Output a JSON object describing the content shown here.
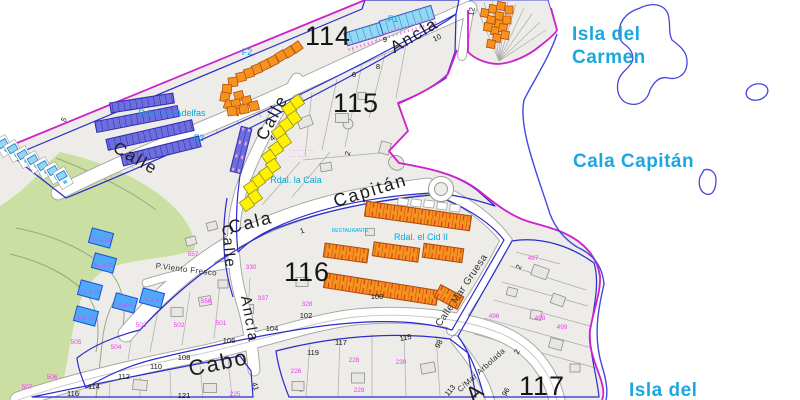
{
  "map": {
    "sea": {
      "isla_carmen_1": "Isla del",
      "isla_carmen_2": "Carmen",
      "cala_capitan": "Cala Capitán",
      "isla_del_partial": "Isla del"
    },
    "zones": [
      {
        "label": "114",
        "x": 328,
        "y": 45
      },
      {
        "label": "115",
        "x": 356,
        "y": 112
      },
      {
        "label": "116",
        "x": 307,
        "y": 281
      },
      {
        "label": "117",
        "x": 542,
        "y": 395
      }
    ],
    "streets": [
      {
        "name": "calle-top-left",
        "label": "Calle",
        "x": 133,
        "y": 163,
        "rot": 30,
        "size": 17
      },
      {
        "name": "ancla-top",
        "label": "Ancla",
        "x": 417,
        "y": 40,
        "rot": -31,
        "size": 17
      },
      {
        "name": "calle-steep",
        "label": "Calle",
        "x": 277,
        "y": 120,
        "rot": -62,
        "size": 17
      },
      {
        "name": "calle-mid",
        "label": "Calle",
        "x": 224,
        "y": 247,
        "rot": 85,
        "size": 15
      },
      {
        "name": "ancla-mid",
        "label": "Ancla",
        "x": 245,
        "y": 320,
        "rot": 80,
        "size": 15
      },
      {
        "name": "cala",
        "label": "Cala",
        "x": 252,
        "y": 228,
        "rot": -14,
        "size": 18
      },
      {
        "name": "capitan",
        "label": "Capitán",
        "x": 372,
        "y": 196,
        "rot": -17,
        "size": 18
      },
      {
        "name": "cabo",
        "label": "Cabo",
        "x": 220,
        "y": 370,
        "rot": -12,
        "size": 22
      },
      {
        "name": "mar-gruesa",
        "label": "Calle Mar Gruesa",
        "x": 464,
        "y": 292,
        "rot": -56,
        "size": 10
      },
      {
        "name": "mar-arbolada",
        "label": "C/Mar Arbolada",
        "x": 483,
        "y": 372,
        "rot": -42,
        "size": 8
      },
      {
        "name": "viento-fresco",
        "label": "P.Viento Fresco",
        "x": 186,
        "y": 272,
        "rot": 7,
        "size": 8
      },
      {
        "name": "avenue-partial",
        "label": "A",
        "x": 480,
        "y": 398,
        "rot": -40,
        "size": 22
      }
    ],
    "urbanizations": [
      {
        "name": "f1",
        "label": "F1",
        "x": 393,
        "y": 22,
        "size": 9
      },
      {
        "name": "f2",
        "label": "F2",
        "x": 247,
        "y": 55,
        "size": 9
      },
      {
        "name": "f3",
        "label": "F3",
        "x": 199,
        "y": 141,
        "size": 9
      },
      {
        "name": "adelfas",
        "label": "Rdal. las Adelfas",
        "x": 172,
        "y": 116,
        "size": 9
      },
      {
        "name": "la-cala",
        "label": "Rdal. la Cala",
        "x": 296,
        "y": 183,
        "size": 9
      },
      {
        "name": "cid",
        "label": "Rdal. el Cid II",
        "x": 421,
        "y": 240,
        "size": 9
      },
      {
        "name": "restaurante",
        "label": "RESTAURANTE",
        "x": 350,
        "y": 232,
        "size": 5
      }
    ],
    "villas": [
      {
        "label": "21 al 24",
        "x": 101,
        "y": 242
      },
      {
        "label": "17 al 20",
        "x": 104,
        "y": 267
      },
      {
        "label": "13 al 16",
        "x": 90,
        "y": 294
      },
      {
        "label": "9 al 12",
        "x": 86,
        "y": 320
      },
      {
        "label": "5 al 8",
        "x": 125,
        "y": 307
      },
      {
        "label": "1 al 4",
        "x": 152,
        "y": 302
      }
    ],
    "parcel_numbers": [
      {
        "v": "557",
        "x": 193,
        "y": 256
      },
      {
        "v": "556",
        "x": 206,
        "y": 303
      },
      {
        "v": "330",
        "x": 251,
        "y": 269
      },
      {
        "v": "337",
        "x": 263,
        "y": 300
      },
      {
        "v": "505",
        "x": 76,
        "y": 344
      },
      {
        "v": "504",
        "x": 116,
        "y": 349
      },
      {
        "v": "503",
        "x": 141,
        "y": 327
      },
      {
        "v": "502",
        "x": 179,
        "y": 327
      },
      {
        "v": "501",
        "x": 221,
        "y": 325
      },
      {
        "v": "506",
        "x": 52,
        "y": 379
      },
      {
        "v": "507",
        "x": 27,
        "y": 389
      },
      {
        "v": "225",
        "x": 235,
        "y": 396
      },
      {
        "v": "226",
        "x": 296,
        "y": 373
      },
      {
        "v": "228",
        "x": 354,
        "y": 362
      },
      {
        "v": "229",
        "x": 359,
        "y": 392
      },
      {
        "v": "230",
        "x": 401,
        "y": 364
      },
      {
        "v": "328",
        "x": 307,
        "y": 306
      },
      {
        "v": "497",
        "x": 533,
        "y": 260
      },
      {
        "v": "496",
        "x": 494,
        "y": 318
      },
      {
        "v": "498",
        "x": 540,
        "y": 320
      },
      {
        "v": "499",
        "x": 562,
        "y": 329
      }
    ],
    "house_numbers": [
      {
        "v": "4",
        "x": 274,
        "y": 140,
        "rot": -40
      },
      {
        "v": "5",
        "x": 66,
        "y": 121,
        "rot": -60
      },
      {
        "v": "6",
        "x": 354,
        "y": 77,
        "rot": 0
      },
      {
        "v": "8",
        "x": 378,
        "y": 69,
        "rot": 0
      },
      {
        "v": "9",
        "x": 385,
        "y": 42,
        "rot": 0
      },
      {
        "v": "10",
        "x": 438,
        "y": 40,
        "rot": -25
      },
      {
        "v": "12",
        "x": 474,
        "y": 12,
        "rot": -78
      },
      {
        "v": "2",
        "x": 350,
        "y": 154,
        "rot": -75
      },
      {
        "v": "1",
        "x": 303,
        "y": 233,
        "rot": -20
      },
      {
        "v": "2",
        "x": 521,
        "y": 268,
        "rot": -65
      },
      {
        "v": "2",
        "x": 519,
        "y": 353,
        "rot": -60
      },
      {
        "v": "98",
        "x": 441,
        "y": 345,
        "rot": -62
      },
      {
        "v": "96",
        "x": 508,
        "y": 393,
        "rot": -62
      },
      {
        "v": "100",
        "x": 377,
        "y": 299,
        "rot": 0
      },
      {
        "v": "102",
        "x": 306,
        "y": 318,
        "rot": 0
      },
      {
        "v": "104",
        "x": 272,
        "y": 331,
        "rot": 0
      },
      {
        "v": "106",
        "x": 229,
        "y": 343,
        "rot": 0
      },
      {
        "v": "108",
        "x": 184,
        "y": 360,
        "rot": 0
      },
      {
        "v": "110",
        "x": 156,
        "y": 369,
        "rot": 0
      },
      {
        "v": "112",
        "x": 124,
        "y": 379,
        "rot": 0
      },
      {
        "v": "114",
        "x": 94,
        "y": 389,
        "rot": 0
      },
      {
        "v": "116",
        "x": 73,
        "y": 396,
        "rot": 0
      },
      {
        "v": "119",
        "x": 313,
        "y": 355,
        "rot": 0
      },
      {
        "v": "117",
        "x": 341,
        "y": 345,
        "rot": 0
      },
      {
        "v": "115",
        "x": 406,
        "y": 340,
        "rot": -10
      },
      {
        "v": "113",
        "x": 452,
        "y": 392,
        "rot": -50
      },
      {
        "v": "121",
        "x": 184,
        "y": 398,
        "rot": 0
      },
      {
        "v": "41",
        "x": 253,
        "y": 387,
        "rot": 75
      }
    ],
    "micro_annotations": [
      {
        "v": "··········",
        "x": 302,
        "y": 152
      },
      {
        "v": "········",
        "x": 300,
        "y": 158
      }
    ],
    "colors": {
      "boundary_magenta": "#CC22CC",
      "coast_blue": "#4646E0",
      "zone_outline_blue": "#2B2BCC",
      "land": "#EDECE8",
      "park_green": "#CBDFA3",
      "orange_building": "#F6921E",
      "cyan_building": "#8FD9F2",
      "indigo_building": "#6E6EDC",
      "yellow_building": "#FFF100",
      "villa_blue": "#4FA8F8",
      "sea_label_cyan": "#1BA7DF",
      "parcel_magenta": "#EE3FEE"
    }
  }
}
